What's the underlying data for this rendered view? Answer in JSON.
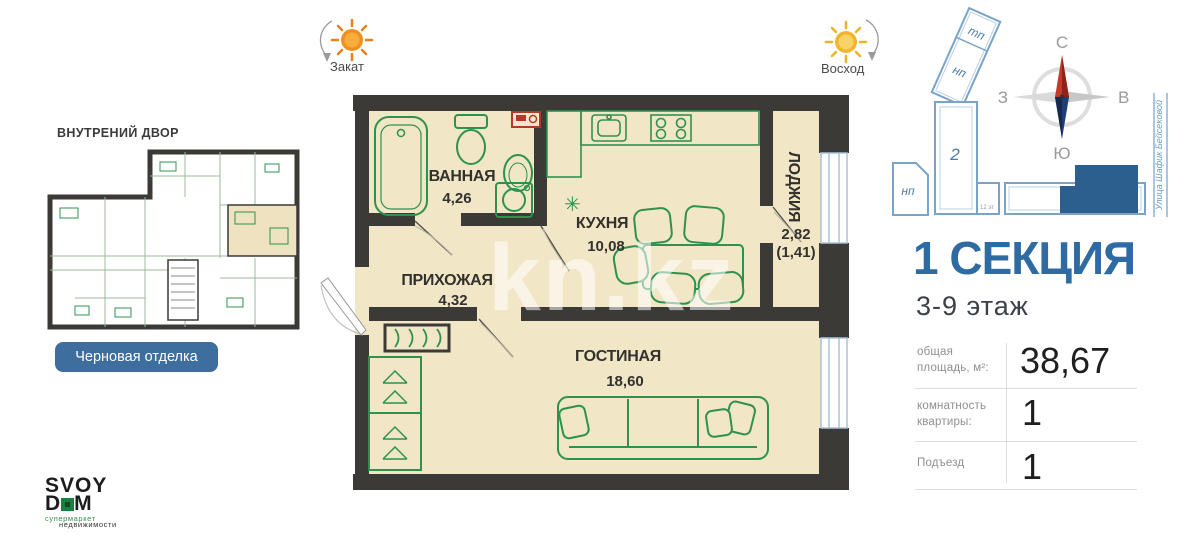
{
  "colors": {
    "accent_blue": "#2f6ba3",
    "button_blue": "#3d6e9e",
    "wall": "#3b3a37",
    "floor": "#f1e6c5",
    "furniture_green": "#2f9150",
    "section_highlight": "#2d5f8e"
  },
  "top": {
    "sunset_label": "Закат",
    "sunrise_label": "Восход"
  },
  "left": {
    "courtyard_label": "ВНУТРЕНИЙ ДВОР",
    "finish_button": "Черновая отделка",
    "logo": {
      "line1": "SVOY",
      "d": "D",
      "m": "M",
      "tagline1": "супермаркет",
      "tagline2": "недвижимости"
    }
  },
  "watermark": "kn.kz",
  "plan": {
    "rooms": {
      "bath": {
        "name": "ВАННАЯ",
        "area": "4,26"
      },
      "hall": {
        "name": "ПРИХОЖАЯ",
        "area": "4,32"
      },
      "kitchen": {
        "name": "КУХНЯ",
        "area": "10,08"
      },
      "loggia": {
        "name": "ЛОДЖИЯ",
        "area": "2,82",
        "area_reduced": "(1,41)"
      },
      "living": {
        "name": "ГОСТИНАЯ",
        "area": "18,60"
      }
    },
    "snowflake_icon": "✳"
  },
  "siteplan": {
    "tp": "тп",
    "np_top": "нп",
    "np_left": "нп",
    "building2": "2",
    "building1": "1",
    "note": "12 эт",
    "street": "Улица Шафик Бейсековой"
  },
  "compass": {
    "n": "С",
    "s": "Ю",
    "w": "З",
    "e": "В"
  },
  "section": {
    "title": "1 СЕКЦИЯ",
    "floors": "3-9 этаж"
  },
  "specs": {
    "area": {
      "label": "общая площадь, м²:",
      "value": "38,67"
    },
    "rooms": {
      "label": "комнатность квартиры:",
      "value": "1"
    },
    "entrance": {
      "label": "Подъезд",
      "value": "1"
    }
  }
}
